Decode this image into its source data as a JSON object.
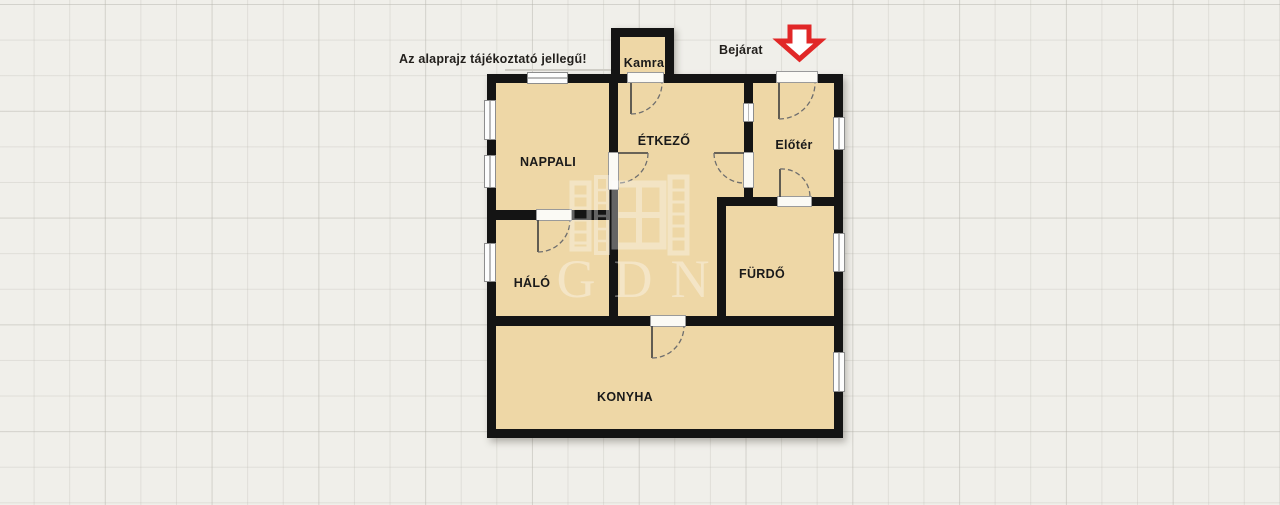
{
  "annotation": {
    "disclaimer": "Az alaprajz tájékoztató jellegű!",
    "entrance_label": "Bejárat"
  },
  "rooms": {
    "kamra": {
      "label": "Kamra"
    },
    "nappali": {
      "label": "NAPPALI"
    },
    "etkezo": {
      "label": "ÉTKEZŐ"
    },
    "eloter": {
      "label": "Előtér"
    },
    "halo": {
      "label": "HÁLÓ"
    },
    "furdo": {
      "label": "FÜRDŐ"
    },
    "konyha": {
      "label": "KONYHA"
    }
  },
  "watermark": {
    "text": "GDN"
  },
  "icons": {
    "entrance_arrow": "red-down-arrow-icon"
  },
  "colors": {
    "background": "#f0efea",
    "grid_line": "#e3e2dd",
    "room_fill": "#eed7a6",
    "wall": "#141414",
    "entrance_arrow_red": "#e12727",
    "label_text": "#1a1a1a",
    "watermark_white": "rgba(255,255,255,0.36)"
  }
}
